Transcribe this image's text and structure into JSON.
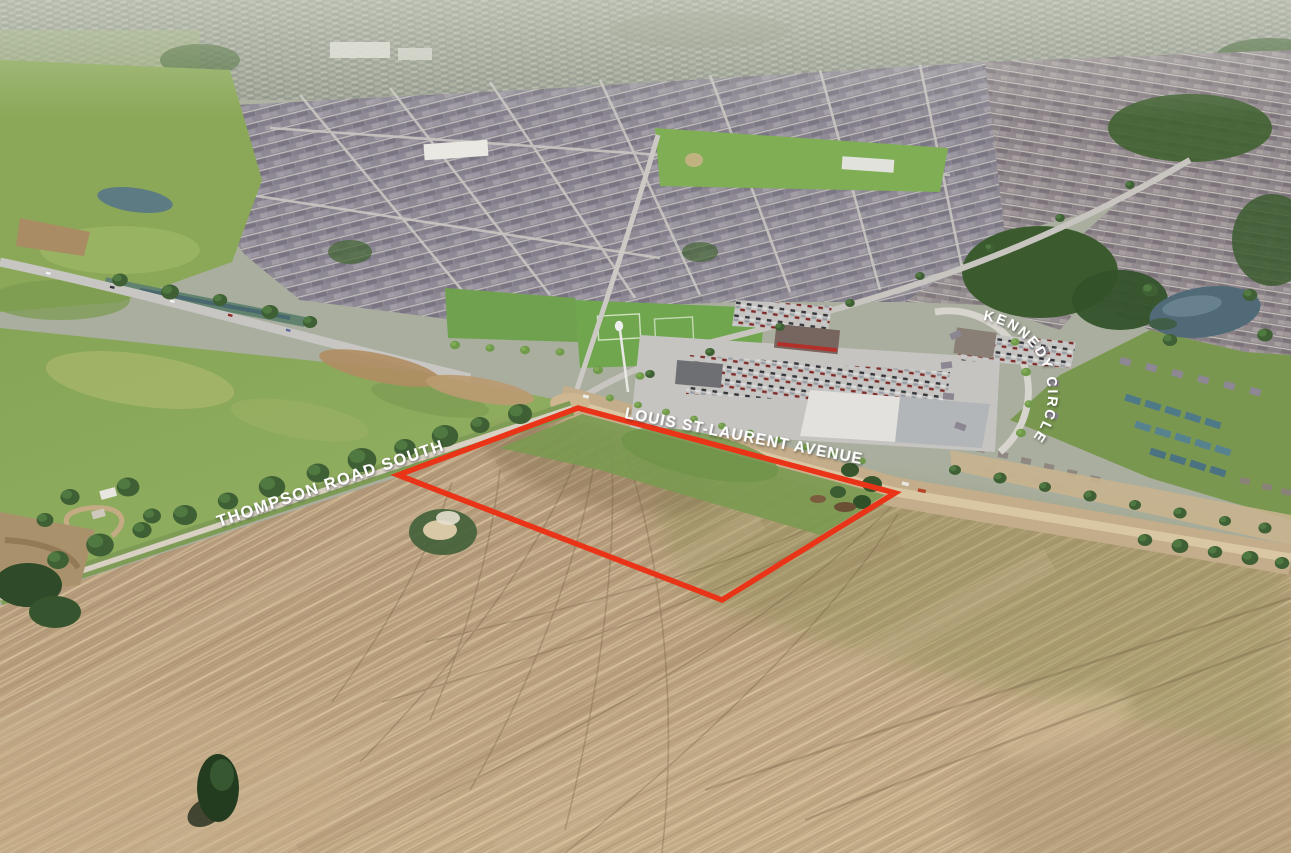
{
  "labels": {
    "thompson_road": "THOMPSON ROAD SOUTH",
    "louis_st_laurent": "LOUIS ST-LAURENT AVENUE",
    "kennedy_circle": "KENNEDY CIRCLE"
  },
  "annotation": {
    "site_outline_color": "#ea3418"
  }
}
